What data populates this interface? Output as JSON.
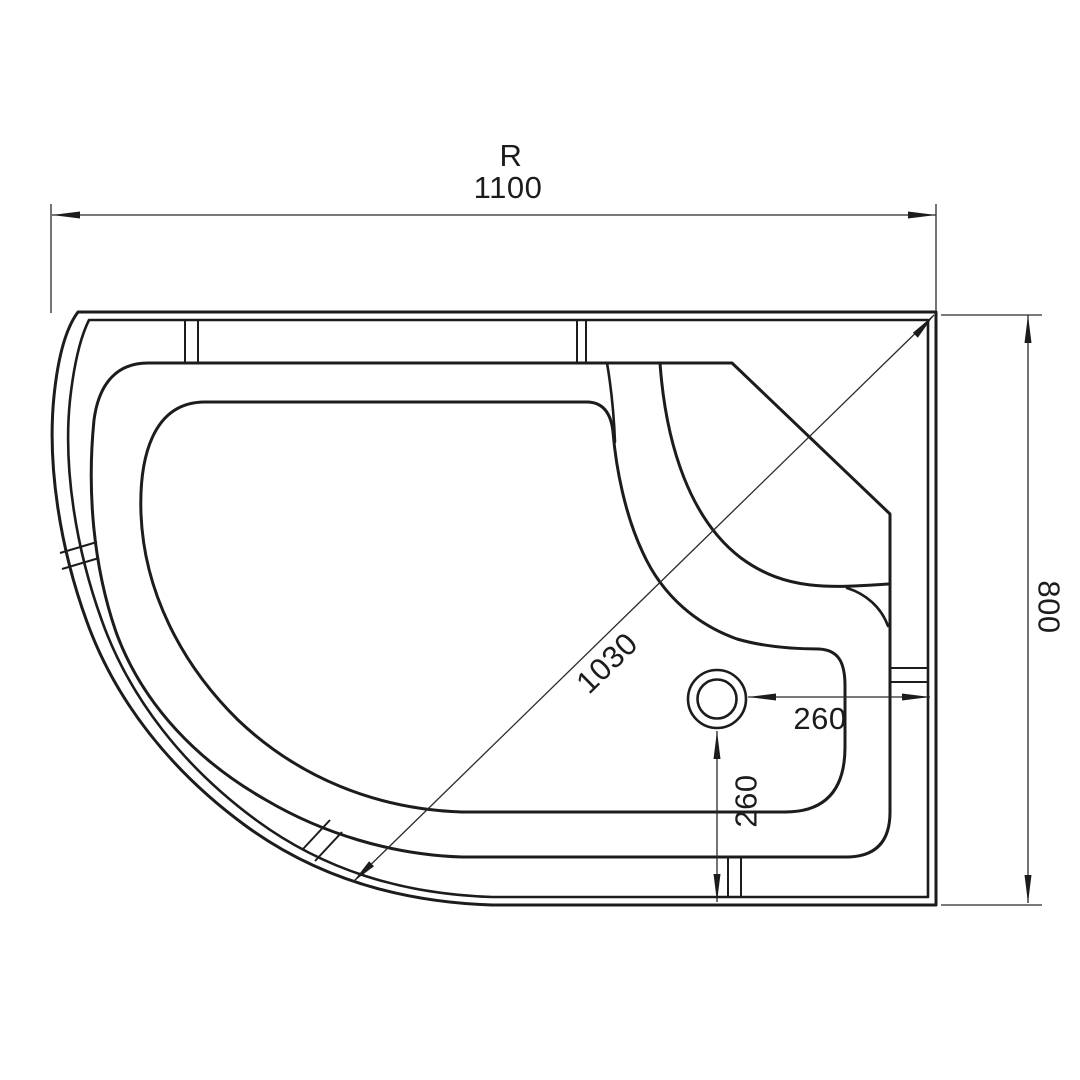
{
  "drawing": {
    "description": "Top-view dimensioned technical drawing of an asymmetric quadrant shower tray, right-hand version",
    "colors": {
      "line": "#1c1c1c",
      "background": "#ffffff"
    },
    "labels": {
      "variant": "R",
      "overall_width": "1100",
      "overall_depth": "800",
      "diagonal": "1030",
      "drain_offset_from_right": "260",
      "drain_offset_from_bottom": "260"
    }
  }
}
